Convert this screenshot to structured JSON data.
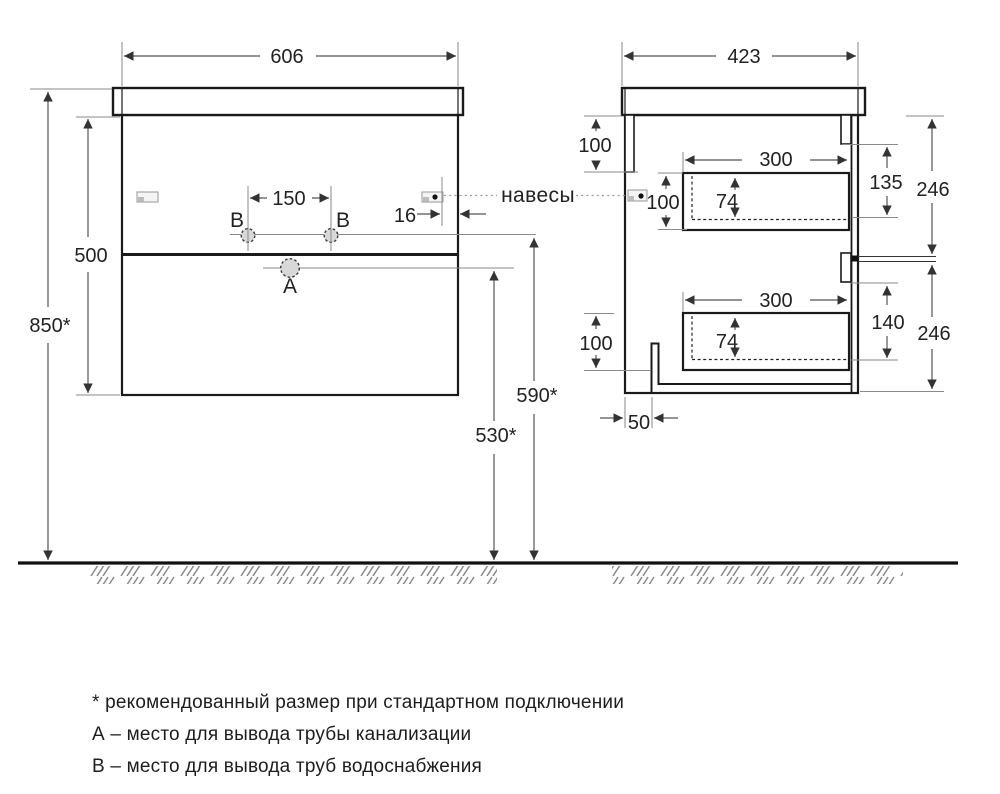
{
  "front_view": {
    "width": "606",
    "body_height": "500",
    "mount_height": "850*",
    "b_spacing": "150",
    "bracket_offset": "16",
    "label_b_left": "B",
    "label_b_right": "B",
    "label_a": "A",
    "supply_height": "590*",
    "drain_height": "530*"
  },
  "side_view": {
    "depth": "423",
    "back_rail_height": "100",
    "upper_drawer": {
      "width": "300",
      "height": "100",
      "inner_height": "74",
      "front_offset": "135",
      "section_height": "246"
    },
    "lower_drawer": {
      "width": "300",
      "height": "100",
      "inner_height": "74",
      "front_offset": "140",
      "section_height": "246"
    },
    "pipe_offset": "50"
  },
  "callouts": {
    "hangers": "навесы"
  },
  "notes": {
    "asterisk": "* рекомендованный размер при стандартном подключении",
    "a": "А – место для вывода трубы канализации",
    "b": "В – место для вывода труб водоснабжения"
  },
  "colors": {
    "line": "#1a1a1a",
    "dimension": "#555555",
    "hole_fill": "#d8d8d8"
  }
}
